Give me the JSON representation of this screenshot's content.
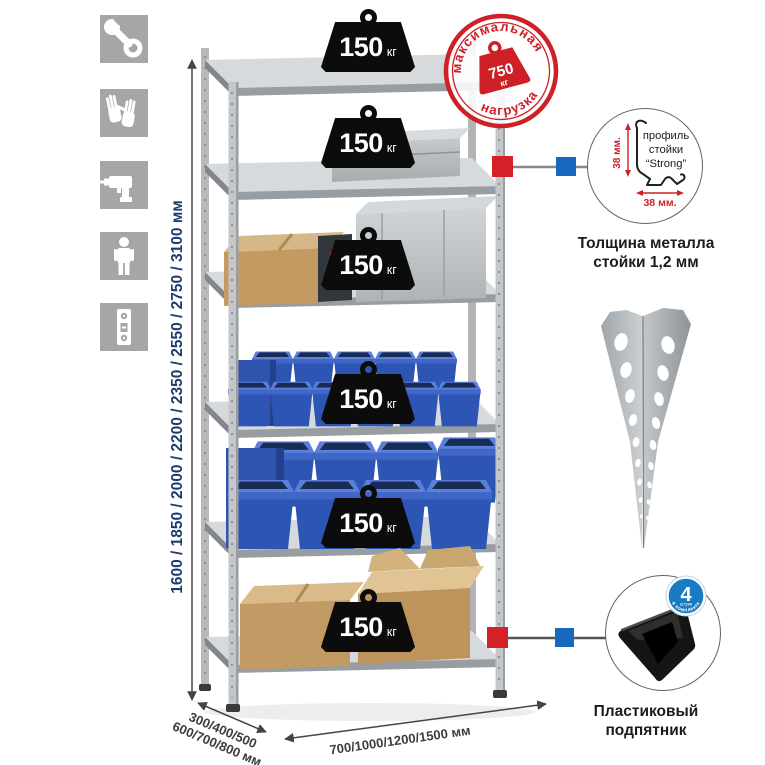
{
  "colors": {
    "accent_red": "#cd2127",
    "accent_blue": "#1669bd",
    "bin_blue": "#2d55b4",
    "metal_gray": "#c3c7ca",
    "icon_gray": "#a6a6a6",
    "dim_text_navy": "#1d3c6e"
  },
  "left_toolbar": {
    "icons": [
      "wrench-icon",
      "gloves-icon",
      "drill-icon",
      "person-icon",
      "level-icon"
    ]
  },
  "rack": {
    "shelf_count": 6,
    "shelf_load_label": {
      "value": "150",
      "unit": "кг"
    }
  },
  "max_load_stamp": {
    "arc_top": "максимальная",
    "arc_bottom": "нагрузка",
    "value": "750",
    "unit": "кг"
  },
  "dimensions": {
    "height_options": "1600 / 1850 / 2000 / 2200 / 2350 / 2550 / 2750 / 3100 мм",
    "depth_options_line1": "300/400/500",
    "depth_options_line2": "600/700/800 мм",
    "width_options": "700/1000/1200/1500 мм"
  },
  "profile_callout": {
    "dim_vertical": "38 мм.",
    "dim_horizontal": "38 мм.",
    "label_line1": "профиль",
    "label_line2": "стойки",
    "label_line3": "“Strong”",
    "caption_line1": "Толщина металла",
    "caption_line2": "стойки 1,2 мм"
  },
  "included_feet": {
    "badge_count": "4",
    "badge_unit": "штуки",
    "badge_arc": "в комплекте",
    "caption_line1": "Пластиковый",
    "caption_line2": "подпятник"
  }
}
